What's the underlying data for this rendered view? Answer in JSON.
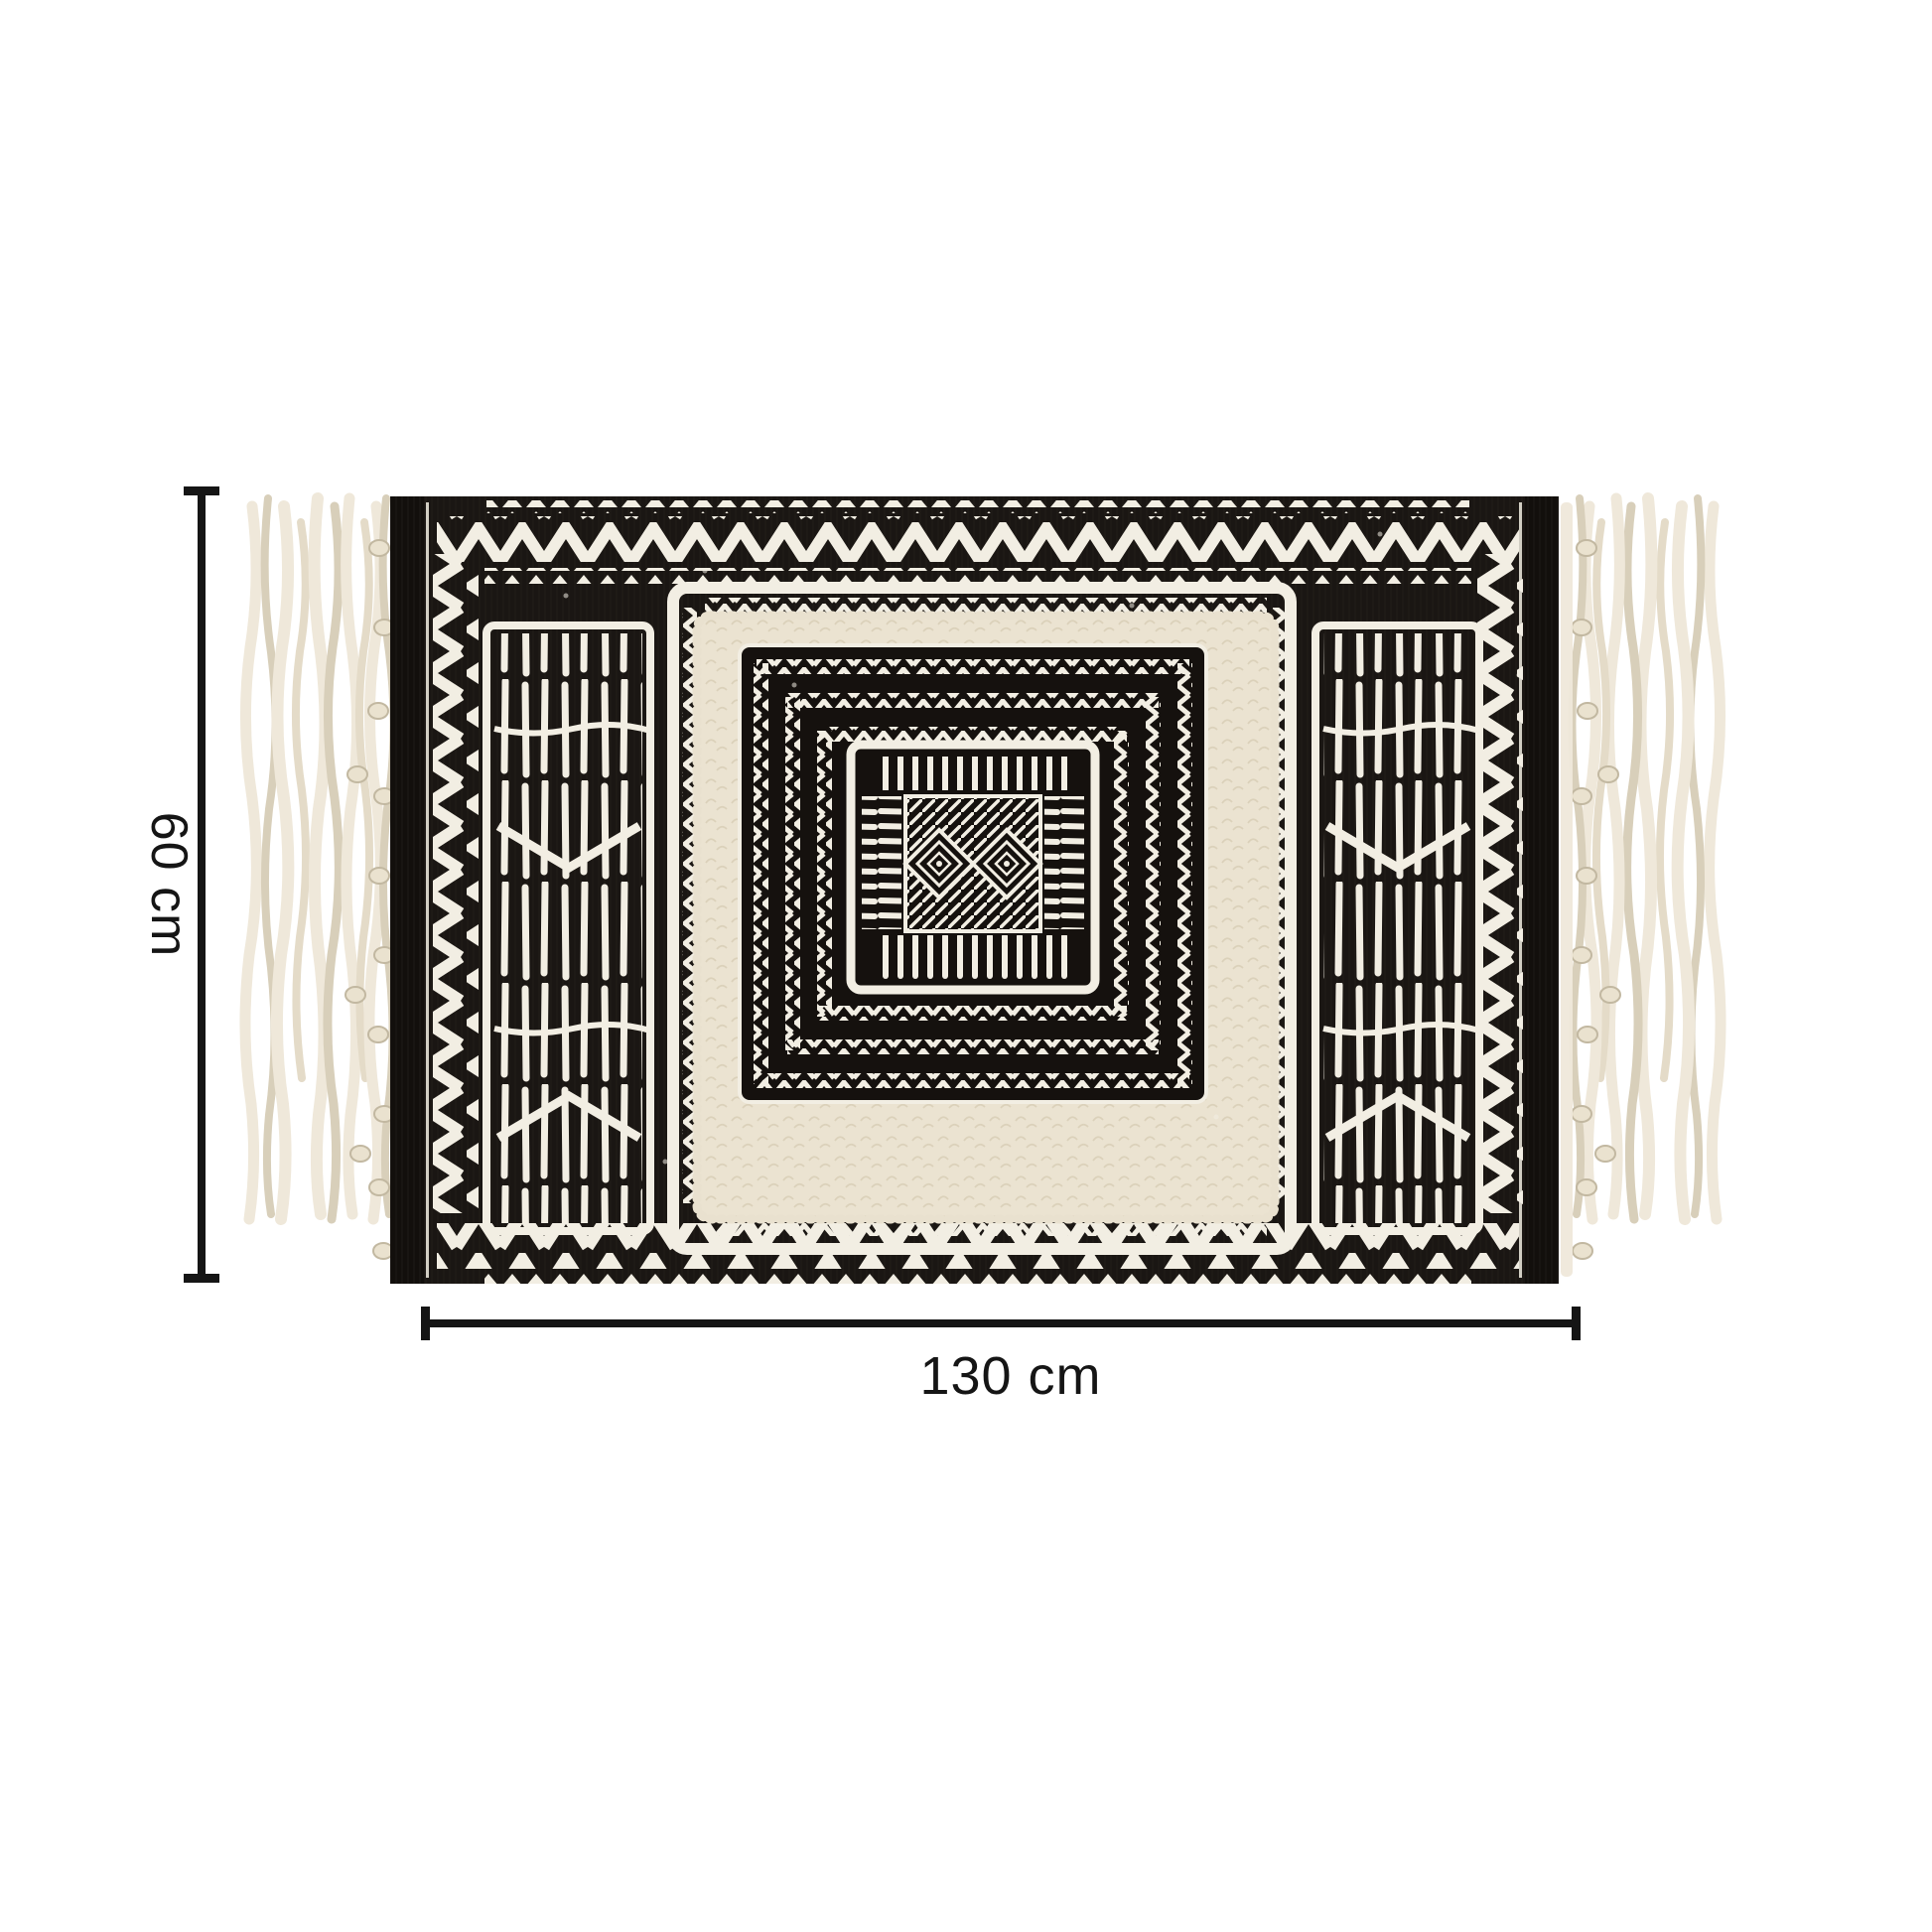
{
  "page": {
    "background": "#ffffff"
  },
  "image": {
    "name": "black-and-white-tribal-boho-rug-with-tassels"
  },
  "annotations": {
    "height": {
      "label": "60 cm"
    },
    "width": {
      "label": "130 cm"
    }
  },
  "colors": {
    "page_bg": "#ffffff",
    "ink": "#151515",
    "rug_black": "#1a1613",
    "rug_white": "#f2eee3",
    "tuft_cream": "#ebe3d1",
    "tassel_cream": "#efe8da",
    "tassel_shade": "#d8cfba"
  }
}
